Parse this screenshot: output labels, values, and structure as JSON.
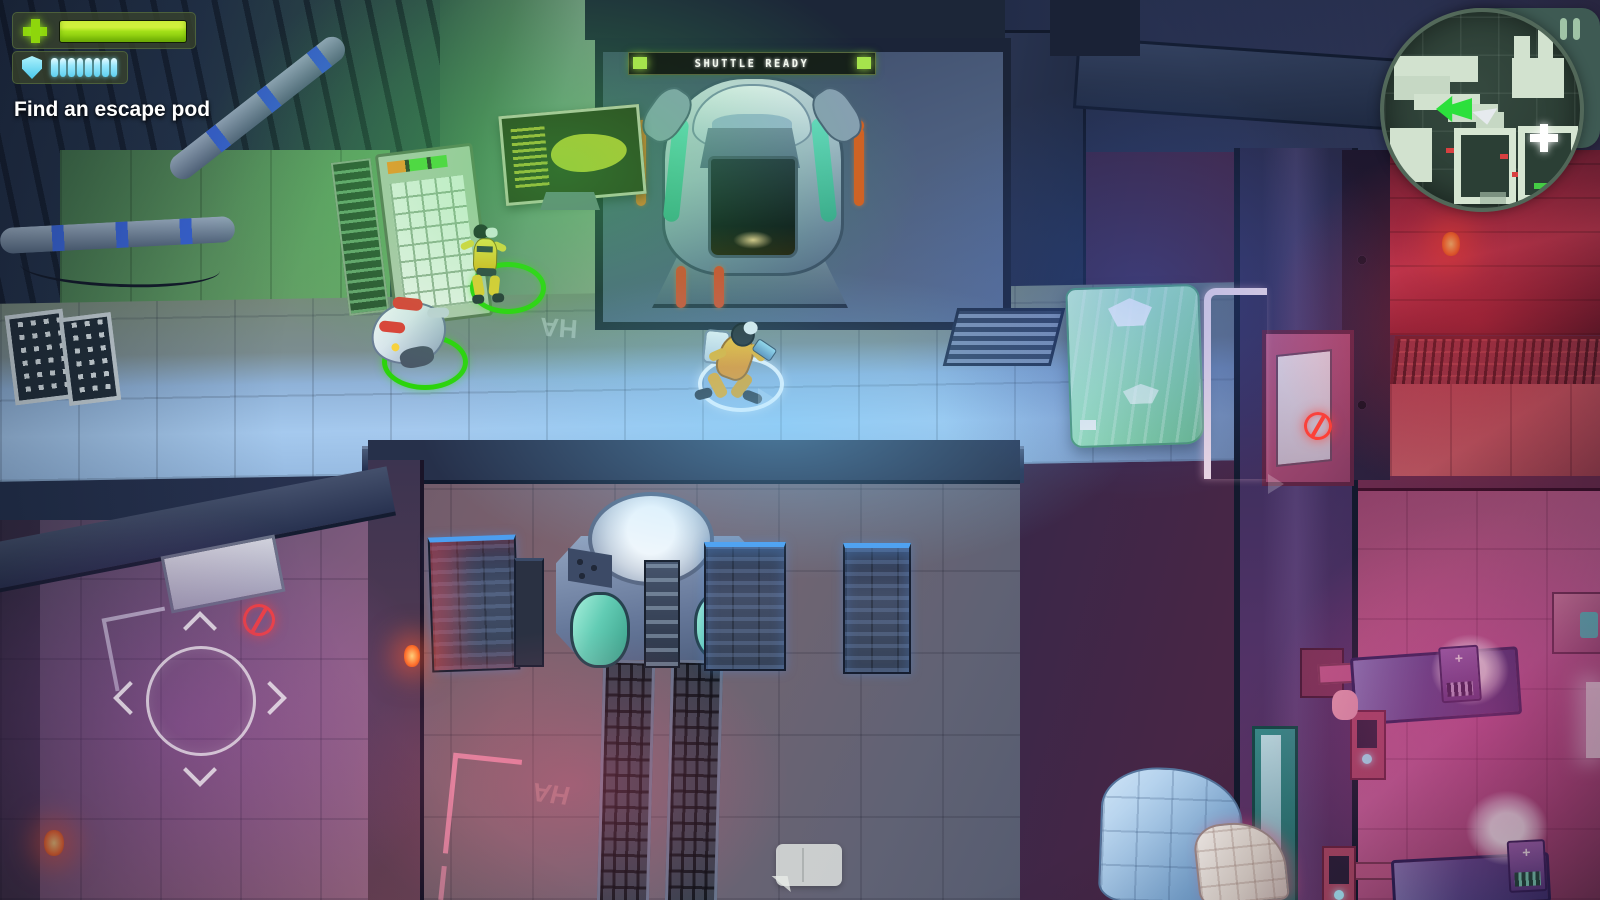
{
  "app": {
    "view": "mission-gameplay",
    "genre": "top-down sci-fi shooter"
  },
  "hud": {
    "objective": {
      "label": "Find an escape pod"
    },
    "health": {
      "icon": "health-cross",
      "value_pct": 100,
      "bar_color": "#a2e018"
    },
    "shield": {
      "icon": "shield",
      "segments": 8,
      "segments_filled": 8,
      "pip_color": "#7ee4fa"
    },
    "pause": {
      "icon": "pause"
    },
    "minimap": {
      "shape": "circular",
      "player_marker": "green-double-arrow",
      "heading_marker": "white-pointer",
      "objective_marker": "white-plus",
      "red_door_markers": 3,
      "green_door_markers": 1
    },
    "joystick": {
      "type": "virtual-move-joystick",
      "arrows": [
        "up",
        "down",
        "left",
        "right"
      ]
    },
    "chat_indicator": {
      "icon": "speech-bubble"
    }
  },
  "scene": {
    "shuttle_banner": {
      "text": "SHUTTLE READY",
      "glow_color": "#a6e44c"
    },
    "floor_marking": "HA",
    "med_plus": "+",
    "locked_door_icon": "no-entry",
    "selection_ring_color": "#2bd40a",
    "player_ring_color": "#ffffff",
    "characters": {
      "player": "player-in-yellow-suit",
      "crew_member": "crew-member-in-yellow",
      "robot": "white-service-robot"
    }
  },
  "colors": {
    "health_green": "#a2e018",
    "shield_cyan": "#7ee4fa",
    "alert_red": "#ff4036",
    "banner_green": "#a6e44c",
    "minimap_map": "#d2e2cf"
  }
}
